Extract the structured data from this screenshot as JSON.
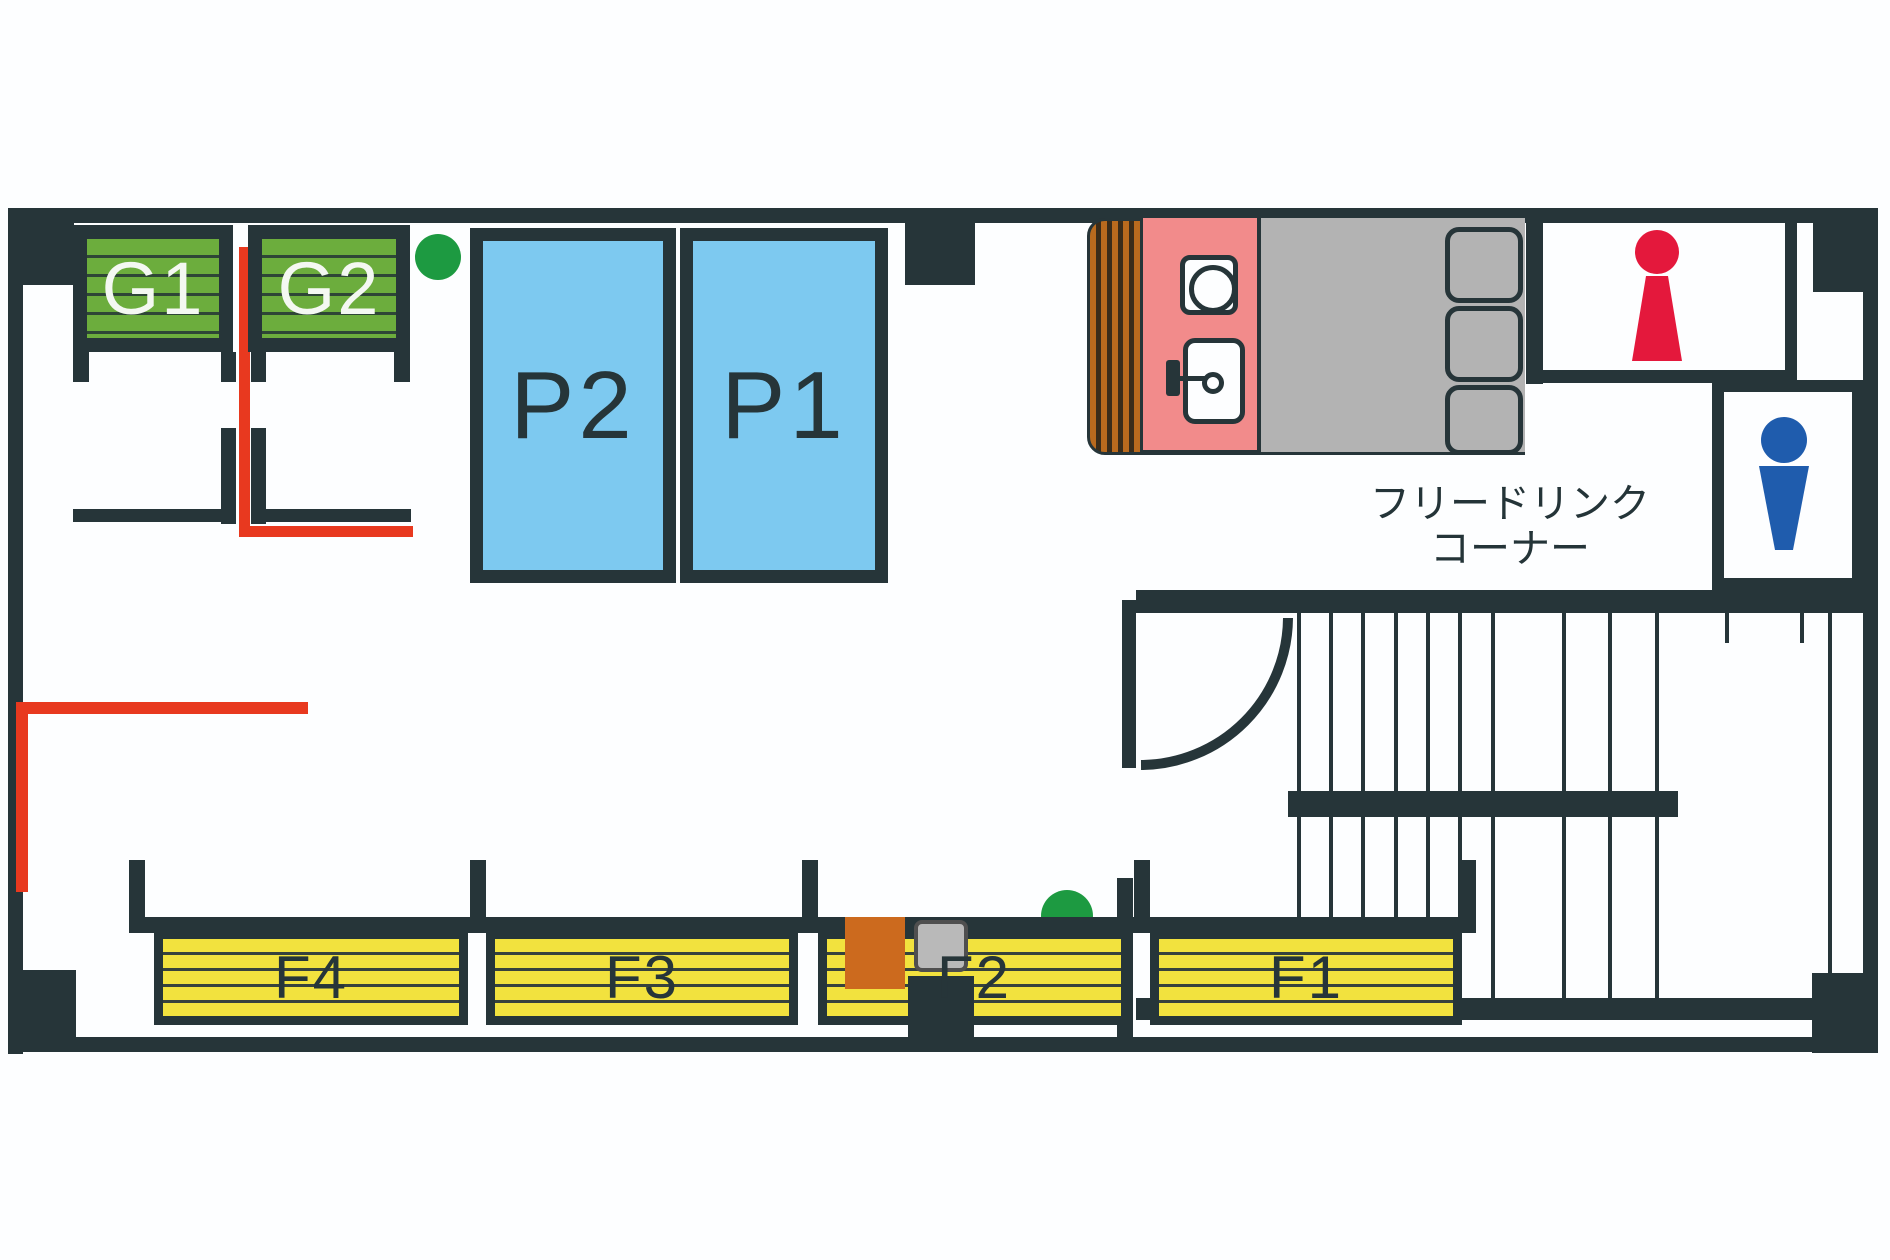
{
  "floorplan": {
    "g_booths": [
      {
        "label": "G1"
      },
      {
        "label": "G2"
      }
    ],
    "p_booths": [
      {
        "label": "P2"
      },
      {
        "label": "P1"
      }
    ],
    "f_booths": [
      {
        "label": "F4"
      },
      {
        "label": "F3"
      },
      {
        "label": "F2"
      },
      {
        "label": "F1"
      }
    ],
    "drink_corner": {
      "line1": "フリードリンク",
      "line2": "コーナー"
    },
    "colors": {
      "wall": "#263539",
      "booth_green": "#6cad3d",
      "booth_blue": "#7dc9f0",
      "booth_yellow": "#f2e23e",
      "counter_pink": "#f28b8b",
      "table_gray": "#b3b3b3",
      "curtain_brown": "#b96a1e",
      "route_red_line": "#e8391f",
      "plant_green": "#1d9a41",
      "female_icon_red": "#e4183c",
      "male_icon_blue": "#1f5cad",
      "bin_orange": "#cc6a1e",
      "bin_gray": "#b9b9b9"
    }
  }
}
